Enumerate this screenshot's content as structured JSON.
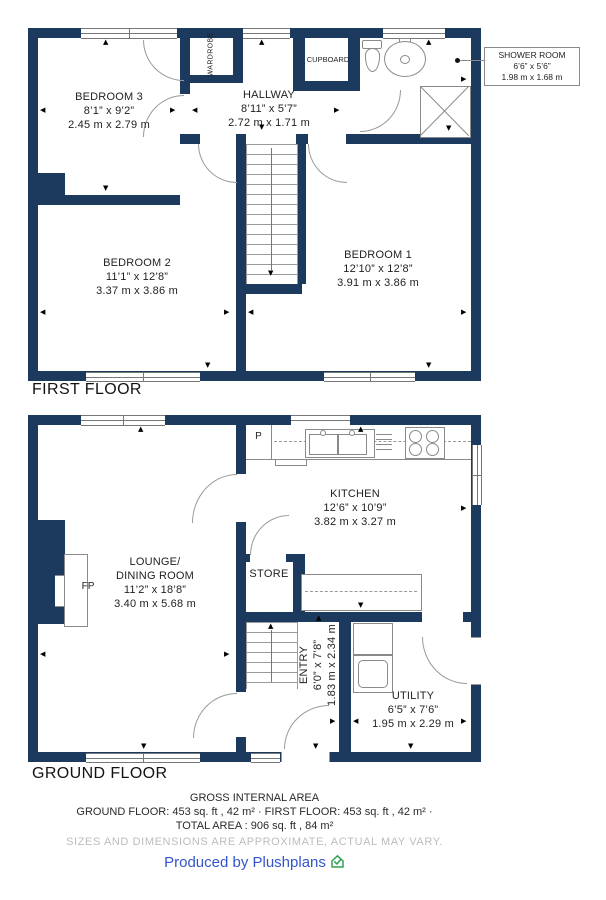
{
  "colors": {
    "wall": "#1B3A5E",
    "fixture_line": "#8a8a8a",
    "brand_blue": "#3355C9",
    "brand_green": "#2EA052",
    "muted_gray": "#bcbcbc"
  },
  "first_floor": {
    "title": "FIRST FLOOR",
    "rooms": {
      "bedroom3": {
        "name": "BEDROOM 3",
        "imperial": "8’1” x 9’2”",
        "metric": "2.45 m x 2.79 m"
      },
      "hallway": {
        "name": "HALLWAY",
        "imperial": "8’11” x 5’7”",
        "metric": "2.72 m x 1.71 m"
      },
      "bedroom2": {
        "name": "BEDROOM 2",
        "imperial": "11’1” x 12’8”",
        "metric": "3.37 m x 3.86 m"
      },
      "bedroom1": {
        "name": "BEDROOM 1",
        "imperial": "12’10” x 12’8”",
        "metric": "3.91 m x 3.86 m"
      },
      "shower": {
        "name": "SHOWER ROOM",
        "imperial": "6’6” x 5’6”",
        "metric": "1.98 m x 1.68 m"
      }
    },
    "closets": {
      "wardrobe": "WARDROBE",
      "cupboard": "CUPBOARD"
    }
  },
  "ground_floor": {
    "title": "GROUND FLOOR",
    "rooms": {
      "lounge": {
        "name": "LOUNGE/\nDINING ROOM",
        "imperial": "11’2” x 18’8”",
        "metric": "3.40 m x 5.68 m"
      },
      "kitchen": {
        "name": "KITCHEN",
        "imperial": "12’6” x 10’9”",
        "metric": "3.82 m x 3.27 m"
      },
      "entry": {
        "name": "ENTRY",
        "imperial": "6’0” x 7’8”",
        "metric": "1.83 m x 2.34 m"
      },
      "utility": {
        "name": "UTILITY",
        "imperial": "6’5” x 7’6”",
        "metric": "1.95 m x 2.29 m"
      }
    },
    "labels": {
      "store": "STORE",
      "fireplace": "FP",
      "pantry": "P"
    }
  },
  "footer": {
    "gross_title": "GROSS INTERNAL AREA",
    "areas_line": "GROUND FLOOR: 453 sq. ft , 42 m² · FIRST FLOOR: 453 sq. ft , 42 m² ·",
    "total_line": "TOTAL AREA : 906 sq. ft , 84 m²",
    "disclaimer": "SIZES AND DIMENSIONS ARE APPROXIMATE, ACTUAL MAY VARY.",
    "credit": "Produced by Plushplans"
  }
}
